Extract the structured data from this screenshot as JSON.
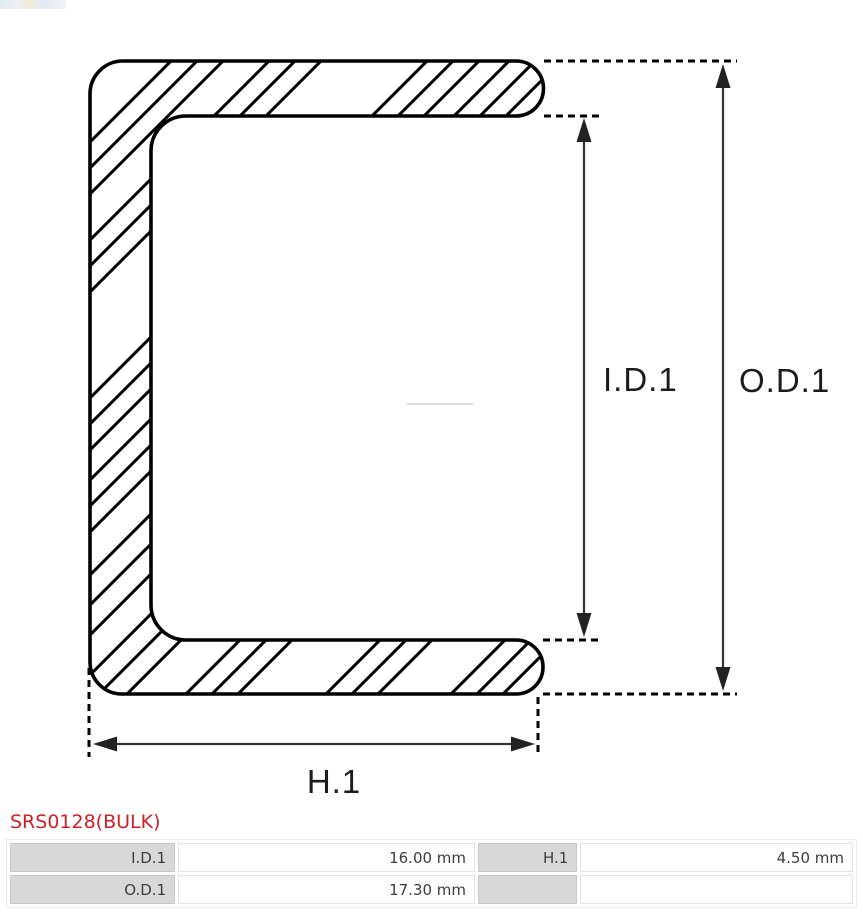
{
  "product": {
    "code": "SRS0128(BULK)"
  },
  "diagram": {
    "labels": {
      "inner_diameter": "I.D.1",
      "outer_diameter": "O.D.1",
      "height": "H.1"
    }
  },
  "specs": {
    "I.D.1": "16.00 mm",
    "O.D.1": "17.30 mm",
    "H.1": "4.50 mm"
  },
  "spec_table": {
    "rows": [
      [
        "I.D.1",
        "16.00 mm",
        "H.1",
        "4.50 mm"
      ],
      [
        "O.D.1",
        "17.30 mm",
        "",
        ""
      ]
    ]
  },
  "colors": {
    "accent_red": "#cc2128",
    "table_header_gray": "#d8d8d8",
    "outline_black": "#000000"
  },
  "icons": {
    "thumbnail": "tiny-image-strip"
  }
}
